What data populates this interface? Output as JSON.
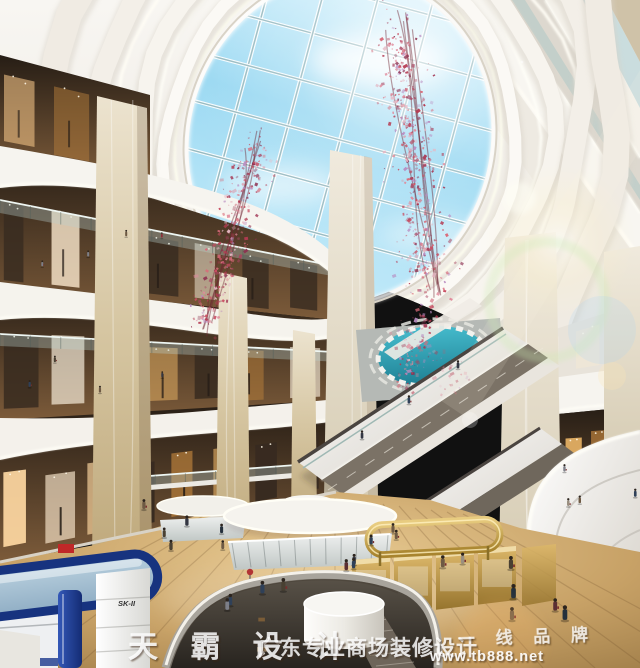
{
  "scene": {
    "label": "shopping-mall-atrium-rendering",
    "width": 640,
    "height": 668
  },
  "watermark": {
    "brand": "天 霸 设 计",
    "tagline": "广东专业商场装修设计",
    "badge": "一 线 品 牌",
    "url": "www.tb888.net"
  },
  "signs": {
    "kiosk_brand": "SK-II"
  },
  "palette": {
    "sky_top": "#d8f2fc",
    "sky_mid": "#9bd9f2",
    "ceiling": "#f2efe9",
    "marble": "#d6c6a2",
    "wood": "#c7a166",
    "gold": "#c9a84c",
    "sk_blue": "#17337f",
    "blossom": [
      "#c94f63",
      "#b53a52",
      "#e08a9b",
      "#a84460",
      "#d96b7a",
      "#b88bc0",
      "#8d3050",
      "#e6b8c4"
    ],
    "shop_warm": [
      "#ffd9a3",
      "#f3c487",
      "#ffedd2",
      "#d9a75f",
      "#b27b3a",
      "#fff6e4"
    ],
    "people": [
      "#333642",
      "#5a2e33",
      "#7d7f88",
      "#2f4058",
      "#6e5a44",
      "#8c2f38",
      "#494032",
      "#24303c",
      "#9a8f80"
    ]
  }
}
